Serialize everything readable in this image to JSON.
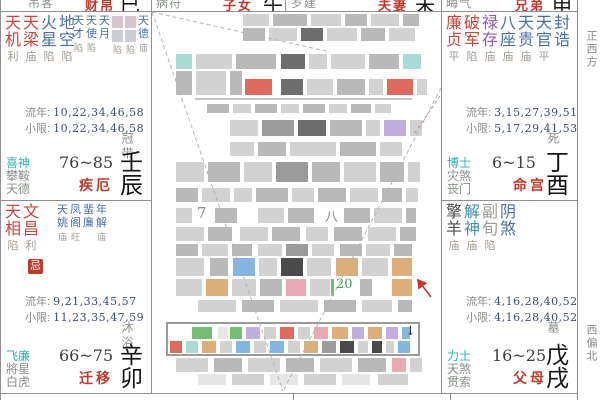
{
  "compass": {
    "top": "正西方",
    "bottom": "西偏北"
  },
  "top_row": [
    {
      "god": "吊客",
      "palace": "财帛",
      "branch": "巳"
    },
    {
      "god": "病符",
      "palace": "子女",
      "branch": "午"
    },
    {
      "god": "岁建",
      "palace": "夫妻",
      "branch": "未"
    },
    {
      "god": "晦气",
      "palace": "兄弟",
      "branch": "申"
    }
  ],
  "colors": {
    "red": "#c8453c",
    "blue": "#4a6fa5",
    "purple": "#9059ad",
    "dark": "#4d4d4d",
    "teal": "#3d8fae",
    "gray": "#9a9a94",
    "accent_red": "#c0392b",
    "god_teal": "#2fb3a9"
  },
  "cells": [
    {
      "id": "jie",
      "main_stars": [
        [
          "天机",
          "利",
          "red"
        ],
        [
          "天梁",
          "庙",
          "red"
        ],
        [
          "火星",
          "陷",
          "blue"
        ],
        [
          "地空",
          "陷",
          "blue"
        ]
      ],
      "minor_stars": [
        [
          "天才",
          "陷"
        ],
        [
          "天使",
          "陷"
        ],
        [
          "天月",
          ""
        ],
        [
          "▒",
          "陷"
        ],
        [
          "▒",
          "陷"
        ],
        [
          "天德",
          "庙"
        ]
      ],
      "liunian_label": "流年:",
      "liunian": "10,22,34,46,58",
      "xiaoxian_label": "小限:",
      "xiaoxian": "10,22,34,46,58",
      "stage": "冠带",
      "gods": [
        "喜神",
        "攀鞍",
        "天德"
      ],
      "age_range": "76~85",
      "palace": "疾厄",
      "stem_branch": "壬辰",
      "badge": ""
    },
    {
      "id": "qianyi",
      "main_stars": [
        [
          "天相",
          "陷",
          "red"
        ],
        [
          "文昌",
          "利",
          "red"
        ]
      ],
      "minor_stars": [
        [
          "天姚",
          "庙"
        ],
        [
          "凤阁",
          "旺"
        ],
        [
          "蜚廉",
          ""
        ],
        [
          "年解",
          "庙"
        ]
      ],
      "liunian_label": "流年:",
      "liunian": "9,21,33,45,57",
      "xiaoxian_label": "小限:",
      "xiaoxian": "11,23,35,47,59",
      "stage": "沐浴",
      "gods": [
        "飞廉",
        "將星",
        "白虎"
      ],
      "age_range": "66~75",
      "palace": "迁移",
      "stem_branch": "辛卯",
      "badge": "忌"
    },
    {
      "id": "ming",
      "main_stars": [
        [
          "廉贞",
          "平",
          "red"
        ],
        [
          "破军",
          "陷",
          "red"
        ],
        [
          "禄存",
          "庙",
          "purple"
        ],
        [
          "八座",
          "庙",
          "blue"
        ],
        [
          "天贵",
          "庙",
          "blue"
        ],
        [
          "天官",
          "平",
          "blue"
        ],
        [
          "封诰",
          "",
          "blue"
        ]
      ],
      "minor_stars": [],
      "liunian_label": "流年:",
      "liunian": "3,15,27,39,51",
      "xiaoxian_label": "小限:",
      "xiaoxian": "5,17,29,41,53",
      "stage": "死",
      "gods": [
        "博士",
        "灾煞",
        "丧门"
      ],
      "age_range": "6~15",
      "palace": "命宫",
      "stem_branch": "丁酉",
      "badge": ""
    },
    {
      "id": "fumu",
      "main_stars": [
        [
          "擎羊",
          "庙",
          "dark"
        ],
        [
          "解神",
          "庙",
          "teal"
        ],
        [
          "副旬",
          "陷",
          "gray"
        ],
        [
          "阴煞",
          "",
          "blue"
        ]
      ],
      "minor_stars": [],
      "liunian_label": "流年:",
      "liunian": "4,16,28,40,52",
      "xiaoxian_label": "小限:",
      "xiaoxian": "4,16,28,40,52",
      "stage": "墓",
      "gods": [
        "力士",
        "天煞",
        "贯索"
      ],
      "age_range": "16~25",
      "palace": "父母",
      "stem_branch": "戊戌",
      "badge": ""
    }
  ],
  "center": {
    "glyphs": [
      {
        "t": "7",
        "x": 197,
        "y": 204,
        "s": 15,
        "c": "#8a8a8a"
      },
      {
        "t": "八",
        "x": 325,
        "y": 206,
        "s": 13,
        "c": "#8a8a8a"
      },
      {
        "t": "20",
        "x": 336,
        "y": 277,
        "s": 13,
        "c": "#4a9e52"
      },
      {
        "t": "↓",
        "x": 405,
        "y": 324,
        "s": 13,
        "c": "#2b2b2b"
      }
    ],
    "palette": {
      "g1": "#e6e6e6",
      "g2": "#d2d2d2",
      "g3": "#b9b9b9",
      "g4": "#9b9b9b",
      "dk": "#6e6e6e",
      "t": "#a9dbd6",
      "r": "#dd6a5d",
      "pu": "#c0aede",
      "bl": "#85b6e2",
      "or": "#dcaf7a",
      "pk": "#e9aab4",
      "gr": "#74bd74",
      "dg": "#4a4a4a"
    },
    "mosaic_rows": [
      {
        "y": 14,
        "h": 12,
        "b": [
          [
            243,
            26,
            "g2"
          ],
          [
            273,
            34,
            "g3"
          ],
          [
            311,
            30,
            "g2"
          ],
          [
            345,
            22,
            "g3"
          ],
          [
            371,
            28,
            "g2"
          ],
          [
            403,
            16,
            "g3"
          ]
        ]
      },
      {
        "y": 28,
        "h": 13,
        "b": [
          [
            243,
            22,
            "g3"
          ],
          [
            269,
            28,
            "g2"
          ],
          [
            301,
            22,
            "dk"
          ],
          [
            327,
            30,
            "g2"
          ],
          [
            361,
            24,
            "g3"
          ],
          [
            389,
            26,
            "g2"
          ]
        ]
      },
      {
        "y": 54,
        "h": 15,
        "b": [
          [
            176,
            16,
            "t"
          ],
          [
            196,
            36,
            "g2"
          ],
          [
            236,
            40,
            "g3"
          ],
          [
            281,
            24,
            "dk"
          ],
          [
            309,
            18,
            "g2"
          ],
          [
            331,
            34,
            "g2"
          ],
          [
            369,
            30,
            "g3"
          ],
          [
            403,
            18,
            "t"
          ]
        ]
      },
      {
        "y": 71,
        "h": 24,
        "b": [
          [
            176,
            16,
            "g3"
          ],
          [
            196,
            30,
            "g2"
          ],
          [
            230,
            12,
            "g3"
          ]
        ]
      },
      {
        "y": 79,
        "h": 16,
        "b": [
          [
            245,
            27,
            "r"
          ],
          [
            281,
            22,
            "dk"
          ],
          [
            307,
            26,
            "g2"
          ],
          [
            337,
            28,
            "g3"
          ],
          [
            369,
            14,
            "g2"
          ],
          [
            387,
            26,
            "r"
          ],
          [
            417,
            10,
            "g2"
          ]
        ]
      },
      {
        "y": 104,
        "h": 9,
        "b": [
          [
            207,
            22,
            "g3"
          ],
          [
            233,
            18,
            "g2"
          ],
          [
            255,
            22,
            "g3"
          ],
          [
            281,
            18,
            "g2"
          ],
          [
            303,
            22,
            "g3"
          ],
          [
            329,
            18,
            "g2"
          ],
          [
            351,
            20,
            "g3"
          ],
          [
            375,
            16,
            "g2"
          ]
        ]
      },
      {
        "y": 120,
        "h": 16,
        "b": [
          [
            230,
            28,
            "g2"
          ],
          [
            262,
            32,
            "g4"
          ],
          [
            298,
            28,
            "dk"
          ],
          [
            330,
            32,
            "g3"
          ],
          [
            366,
            14,
            "g2"
          ],
          [
            384,
            22,
            "pu"
          ],
          [
            410,
            12,
            "g2"
          ]
        ]
      },
      {
        "y": 142,
        "h": 14,
        "b": [
          [
            230,
            24,
            "g2"
          ],
          [
            258,
            28,
            "g3"
          ],
          [
            290,
            46,
            "g2"
          ],
          [
            340,
            36,
            "g3"
          ],
          [
            380,
            22,
            "g2"
          ]
        ]
      },
      {
        "y": 162,
        "h": 20,
        "b": [
          [
            176,
            28,
            "g2"
          ],
          [
            208,
            32,
            "g3"
          ],
          [
            244,
            28,
            "g2"
          ],
          [
            276,
            32,
            "g4"
          ],
          [
            312,
            28,
            "g3"
          ],
          [
            344,
            32,
            "g2"
          ],
          [
            380,
            24,
            "g3"
          ],
          [
            408,
            12,
            "g2"
          ]
        ]
      },
      {
        "y": 188,
        "h": 14,
        "b": [
          [
            176,
            22,
            "g3"
          ],
          [
            202,
            28,
            "g2"
          ],
          [
            234,
            18,
            "g2"
          ],
          [
            256,
            32,
            "g3"
          ],
          [
            292,
            22,
            "g2"
          ],
          [
            318,
            28,
            "g3"
          ],
          [
            350,
            28,
            "g2"
          ],
          [
            382,
            20,
            "g3"
          ],
          [
            406,
            12,
            "g2"
          ]
        ]
      },
      {
        "y": 208,
        "h": 15,
        "b": [
          [
            176,
            16,
            "g2"
          ],
          [
            215,
            22,
            "g3"
          ],
          [
            258,
            26,
            "g2"
          ],
          [
            288,
            26,
            "g3"
          ],
          [
            344,
            26,
            "g3"
          ],
          [
            374,
            28,
            "g2"
          ],
          [
            406,
            10,
            "g3"
          ]
        ]
      },
      {
        "y": 227,
        "h": 14,
        "b": [
          [
            176,
            28,
            "g2"
          ],
          [
            208,
            24,
            "g3"
          ],
          [
            240,
            28,
            "g2"
          ],
          [
            272,
            28,
            "g3"
          ],
          [
            306,
            22,
            "g2"
          ],
          [
            334,
            28,
            "g3"
          ],
          [
            368,
            28,
            "g2"
          ],
          [
            400,
            16,
            "g3"
          ]
        ]
      },
      {
        "y": 244,
        "h": 12,
        "b": [
          [
            176,
            22,
            "g3"
          ],
          [
            202,
            26,
            "g2"
          ],
          [
            232,
            20,
            "g3"
          ],
          [
            258,
            24,
            "g2"
          ],
          [
            286,
            22,
            "g4"
          ],
          [
            312,
            22,
            "g2"
          ],
          [
            340,
            22,
            "g3"
          ],
          [
            366,
            24,
            "g2"
          ],
          [
            394,
            18,
            "g3"
          ]
        ]
      },
      {
        "y": 258,
        "h": 18,
        "b": [
          [
            176,
            28,
            "g2"
          ],
          [
            210,
            18,
            "g3"
          ],
          [
            233,
            22,
            "bl"
          ],
          [
            259,
            18,
            "g2"
          ],
          [
            281,
            22,
            "dg"
          ],
          [
            307,
            24,
            "g2"
          ],
          [
            336,
            22,
            "or"
          ],
          [
            362,
            26,
            "g2"
          ],
          [
            392,
            20,
            "or"
          ]
        ]
      },
      {
        "y": 279,
        "h": 17,
        "b": [
          [
            176,
            26,
            "g2"
          ],
          [
            206,
            22,
            "or"
          ],
          [
            232,
            24,
            "g2"
          ],
          [
            260,
            22,
            "g3"
          ],
          [
            286,
            20,
            "pk"
          ],
          [
            310,
            20,
            "g2"
          ],
          [
            331,
            3,
            "gr"
          ],
          [
            360,
            12,
            "g3"
          ],
          [
            392,
            20,
            "or"
          ]
        ]
      },
      {
        "y": 300,
        "h": 12,
        "b": [
          [
            198,
            38,
            "g2"
          ],
          [
            242,
            32,
            "g3"
          ],
          [
            280,
            38,
            "g2"
          ],
          [
            324,
            32,
            "g3"
          ],
          [
            362,
            30,
            "g2"
          ],
          [
            398,
            14,
            "g3"
          ]
        ]
      },
      {
        "y": 358,
        "h": 14,
        "b": [
          [
            176,
            32,
            "g2"
          ],
          [
            214,
            28,
            "g3"
          ],
          [
            248,
            32,
            "g2"
          ],
          [
            286,
            28,
            "g3"
          ],
          [
            320,
            32,
            "g2"
          ],
          [
            358,
            28,
            "g3"
          ],
          [
            392,
            14,
            "pk"
          ],
          [
            410,
            12,
            "g2"
          ]
        ]
      },
      {
        "y": 374,
        "h": 11,
        "b": [
          [
            198,
            28,
            "g1"
          ],
          [
            232,
            32,
            "g2"
          ],
          [
            270,
            28,
            "g1"
          ],
          [
            304,
            32,
            "g2"
          ],
          [
            342,
            28,
            "g1"
          ],
          [
            378,
            30,
            "g2"
          ]
        ]
      }
    ],
    "toolbar_rows": [
      {
        "y": 327,
        "h": 12,
        "b": [
          [
            192,
            20,
            "gr"
          ],
          [
            218,
            10,
            "g1"
          ],
          [
            230,
            12,
            "gr"
          ],
          [
            246,
            14,
            "pu"
          ],
          [
            264,
            12,
            "g2"
          ],
          [
            280,
            14,
            "r"
          ],
          [
            298,
            12,
            "g2"
          ],
          [
            314,
            14,
            "pk"
          ],
          [
            332,
            16,
            "or"
          ],
          [
            352,
            12,
            "pu"
          ],
          [
            368,
            14,
            "or"
          ],
          [
            386,
            12,
            "pu"
          ],
          [
            402,
            8,
            "bl"
          ]
        ]
      },
      {
        "y": 341,
        "h": 12,
        "b": [
          [
            170,
            12,
            "r"
          ],
          [
            186,
            12,
            "t"
          ],
          [
            202,
            14,
            "or"
          ],
          [
            220,
            12,
            "g2"
          ],
          [
            236,
            14,
            "bl"
          ],
          [
            254,
            12,
            "g2"
          ],
          [
            270,
            14,
            "bl"
          ],
          [
            288,
            12,
            "g2"
          ],
          [
            304,
            14,
            "or"
          ],
          [
            322,
            14,
            "g4"
          ],
          [
            340,
            14,
            "dg"
          ],
          [
            358,
            10,
            "g2"
          ],
          [
            372,
            10,
            "dg"
          ],
          [
            386,
            8,
            "g2"
          ],
          [
            398,
            12,
            "bl"
          ]
        ]
      }
    ]
  }
}
